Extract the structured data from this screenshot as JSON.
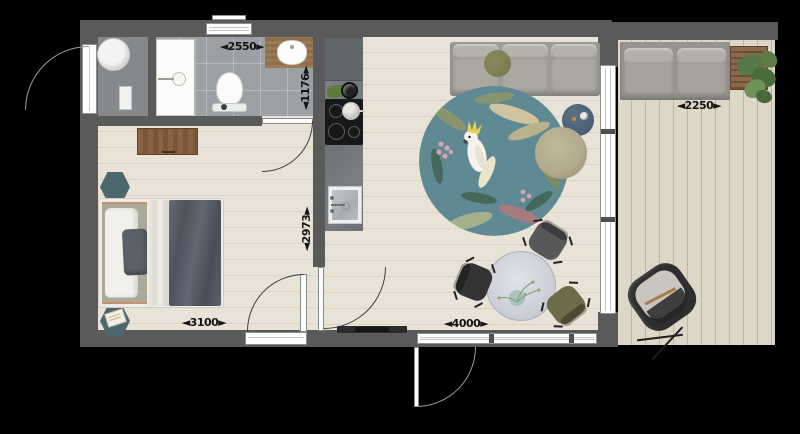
{
  "dimensions": {
    "bath_width": {
      "label": "◄2550►",
      "value_mm": 2550
    },
    "bath_depth": {
      "label": "◄1176►",
      "value_mm": 1176,
      "orientation": "vertical"
    },
    "bedroom_depth": {
      "label": "◄2973►",
      "value_mm": 2973,
      "orientation": "vertical"
    },
    "bedroom_width": {
      "label": "◄3100►",
      "value_mm": 3100
    },
    "living_width": {
      "label": "◄4000►",
      "value_mm": 4000
    },
    "terrace_width": {
      "label": "◄2250►",
      "value_mm": 2250
    }
  },
  "palette": {
    "wall": "#5a5a5a",
    "wood": "#e7e0d4",
    "tile": "#9aa0a4",
    "deck": "#ddd6c6",
    "counter": "#75797d",
    "unit": "#616669",
    "rug": "#5f8a94",
    "sofa": "#9e9b96",
    "olive": "#7c7b4f",
    "bed_sage": "#a8ab97",
    "bed_dark": "#5a6168",
    "duvet_white": "#e9e7e2",
    "copper": "#c98f72",
    "hex_teal": "#4d686d",
    "pouf": "#b4aa8d",
    "marble": "#cdd0d8",
    "chair_dark": "#57585a",
    "chair_black": "#343434",
    "chair_olive": "#6e6c48",
    "side_table_blue": "#4c6377",
    "furniture_wood": "#8a6243",
    "cooktop": "#17181a"
  },
  "furniture": [
    "boiler",
    "shower",
    "toilet",
    "washbasin",
    "dresser",
    "double-bed",
    "hexagonal-side-tables",
    "kitchen-block-with-cooktop-and-sink",
    "three-seat-sofa",
    "round-tropical-rug-with-cockatoo",
    "blue-side-table",
    "pouf",
    "round-dining-table",
    "dining-chairs",
    "doormat",
    "outdoor-sofa",
    "wooden-planter-with-plant",
    "hanging-lounge-chair"
  ]
}
